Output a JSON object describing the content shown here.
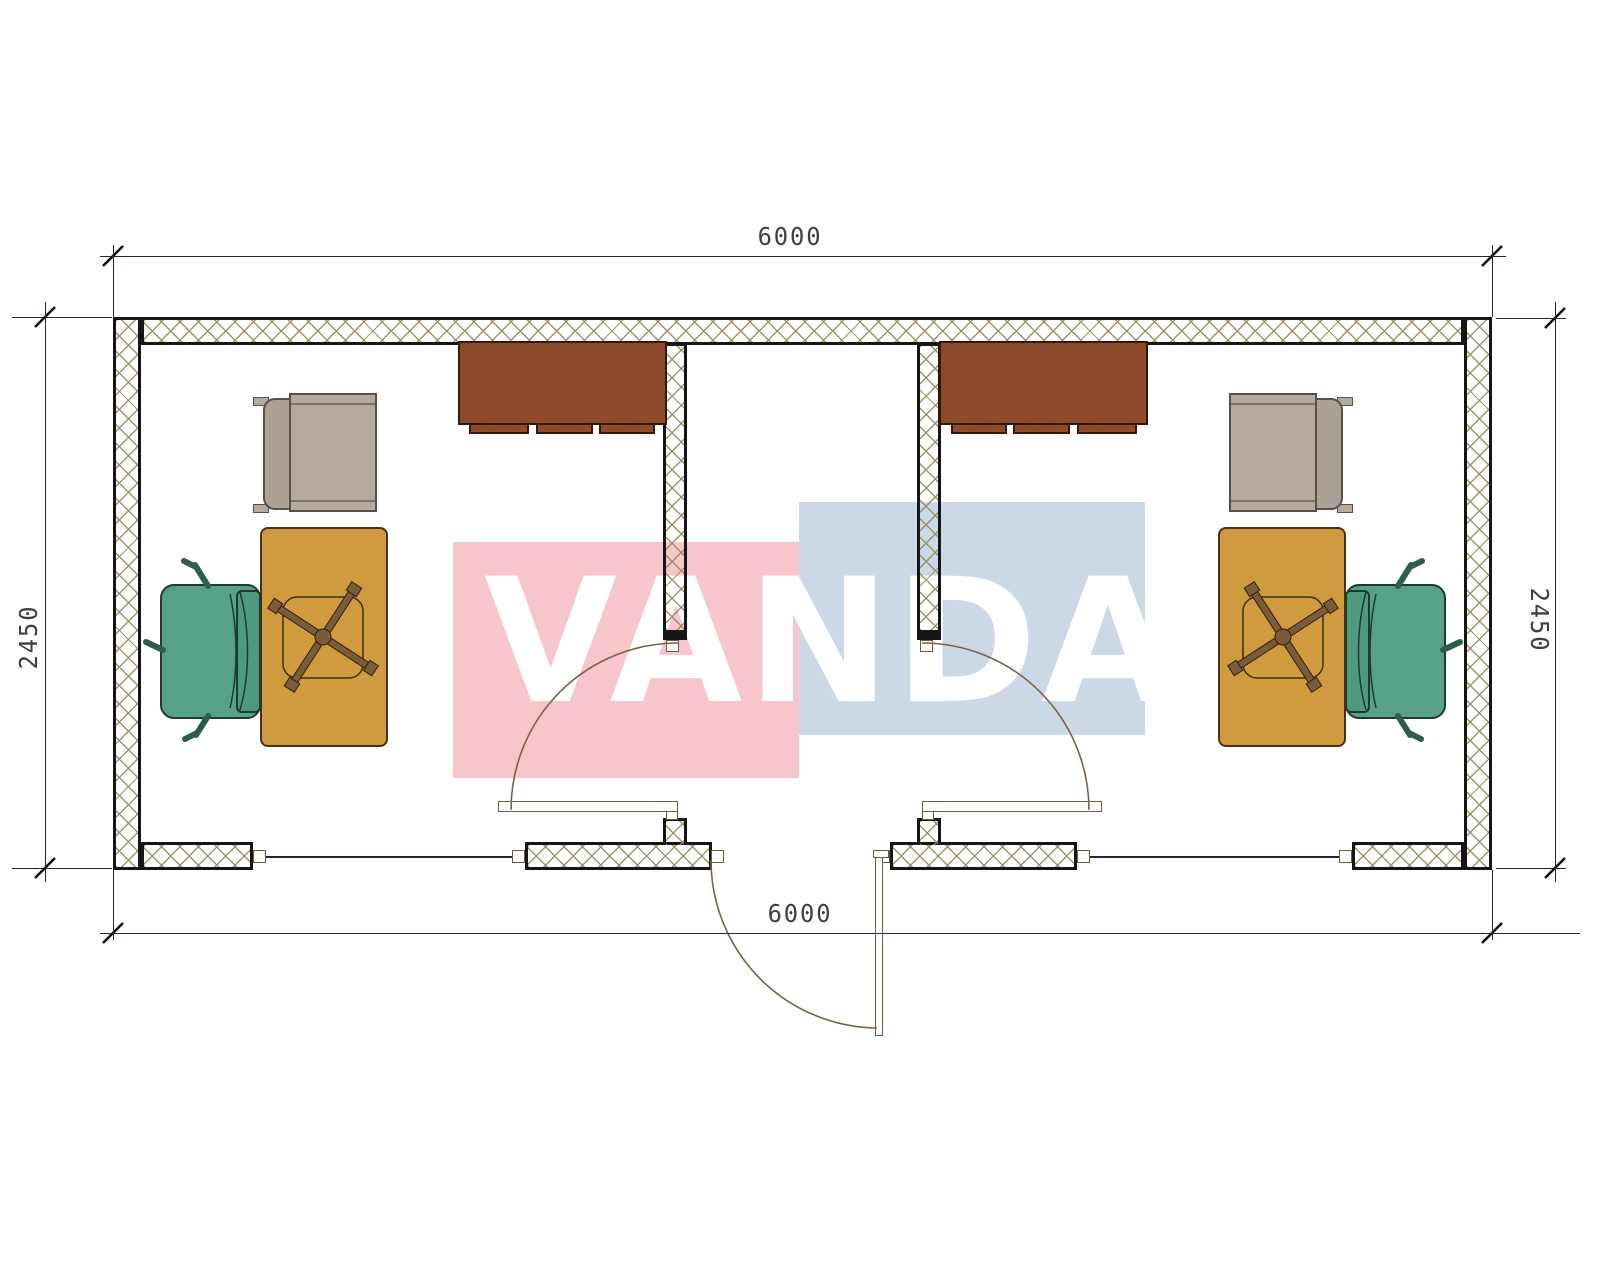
{
  "title": "Container office floor plan 6000 x 2450 with two rooms and central entry",
  "watermark": {
    "text": "VANDA",
    "red_color": "#f6c6cc",
    "blue_color": "#cdd8e6",
    "text_color": "#ffffff"
  },
  "dimensions": {
    "top": "6000",
    "bottom": "6000",
    "left": "2450",
    "right": "2450"
  },
  "plan": {
    "exterior_walls": {
      "fill": "cross-hatch",
      "hatch_line_color": "#968860",
      "outline_color": "#161616"
    },
    "partitions": [
      {
        "name": "left-partition",
        "from": "top-wall",
        "to": "corridor-door"
      },
      {
        "name": "right-partition",
        "from": "top-wall",
        "to": "corridor-door"
      }
    ],
    "doors": [
      {
        "name": "left-room-door",
        "swing": "into-left-room",
        "arc_color": "#7a6147"
      },
      {
        "name": "right-room-door",
        "swing": "into-right-room",
        "arc_color": "#7a6147"
      },
      {
        "name": "main-entrance-door",
        "swing": "outward",
        "arc_color": "#7a6147"
      }
    ],
    "windows": [
      {
        "name": "left-room-window",
        "location": "bottom-wall"
      },
      {
        "name": "right-room-window",
        "location": "bottom-wall"
      }
    ],
    "furniture": {
      "left_room": [
        {
          "kind": "wall-cabinet",
          "color": "#8d4a28"
        },
        {
          "kind": "armchair",
          "color": "#b5aaa0"
        },
        {
          "kind": "desk",
          "color": "#d09b3e"
        },
        {
          "kind": "task-chair-base-symbol",
          "color": "#7b5c3a"
        },
        {
          "kind": "office-chair",
          "color": "#57a189"
        }
      ],
      "right_room": [
        {
          "kind": "wall-cabinet",
          "color": "#8d4a28"
        },
        {
          "kind": "armchair",
          "color": "#b5aaa0"
        },
        {
          "kind": "desk",
          "color": "#d09b3e"
        },
        {
          "kind": "task-chair-base-symbol",
          "color": "#7b5c3a"
        },
        {
          "kind": "office-chair",
          "color": "#57a189"
        }
      ]
    }
  },
  "palette": {
    "dimension_lines": "#23233a",
    "dimension_text": "#3f3f3f",
    "paper": "#ffffff"
  }
}
